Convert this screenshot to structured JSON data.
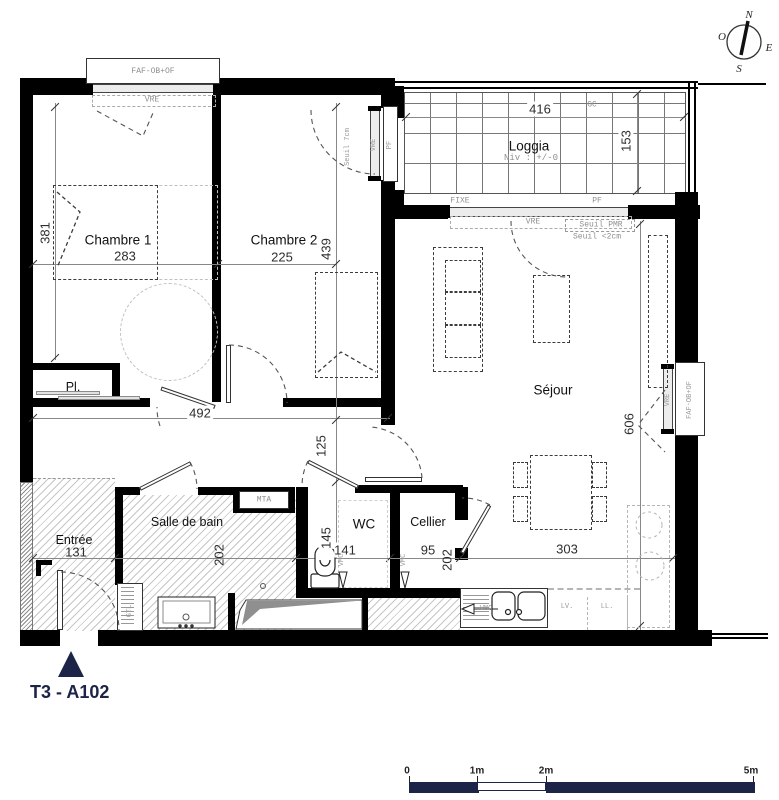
{
  "unit_label": "T3 -  A102",
  "compass": {
    "n": "N",
    "e": "E",
    "s": "S",
    "w": "O"
  },
  "rooms": {
    "chambre1": {
      "name": "Chambre 1",
      "width": "283",
      "height": "381"
    },
    "chambre2": {
      "name": "Chambre 2",
      "width": "225",
      "height": "439"
    },
    "loggia": {
      "name": "Loggia",
      "level": "Niv : +/-0",
      "width": "416",
      "depth": "153"
    },
    "sejour": {
      "name": "Séjour",
      "height": "606",
      "width": "303"
    },
    "entree": {
      "name": "Entrée",
      "width": "131"
    },
    "salle_de_bain": {
      "name": "Salle de bain",
      "height": "202"
    },
    "wc": {
      "name": "WC",
      "width": "141",
      "height": "145"
    },
    "cellier": {
      "name": "Cellier",
      "width": "95",
      "height": "202"
    },
    "placard": {
      "name": "Pl."
    }
  },
  "dims": {
    "hall_width": "492",
    "hall_depth": "125"
  },
  "tags": {
    "faf": "FAF-OB+OF",
    "vre": "VRE",
    "pf": "PF",
    "fixe": "FIXE",
    "gc": "GC",
    "mta": "MTA",
    "gtl": "GTL",
    "vmc": "VMC",
    "lv": "LV.",
    "ll": "LL.",
    "seuil_pmr": "Seuil PMR",
    "seuil_2cm": "Seuil <2cm",
    "seuil_7cm": "Seuil 7cm"
  },
  "scalebar": {
    "t0": "0",
    "t1": "1m",
    "t2": "2m",
    "t5": "5m"
  }
}
